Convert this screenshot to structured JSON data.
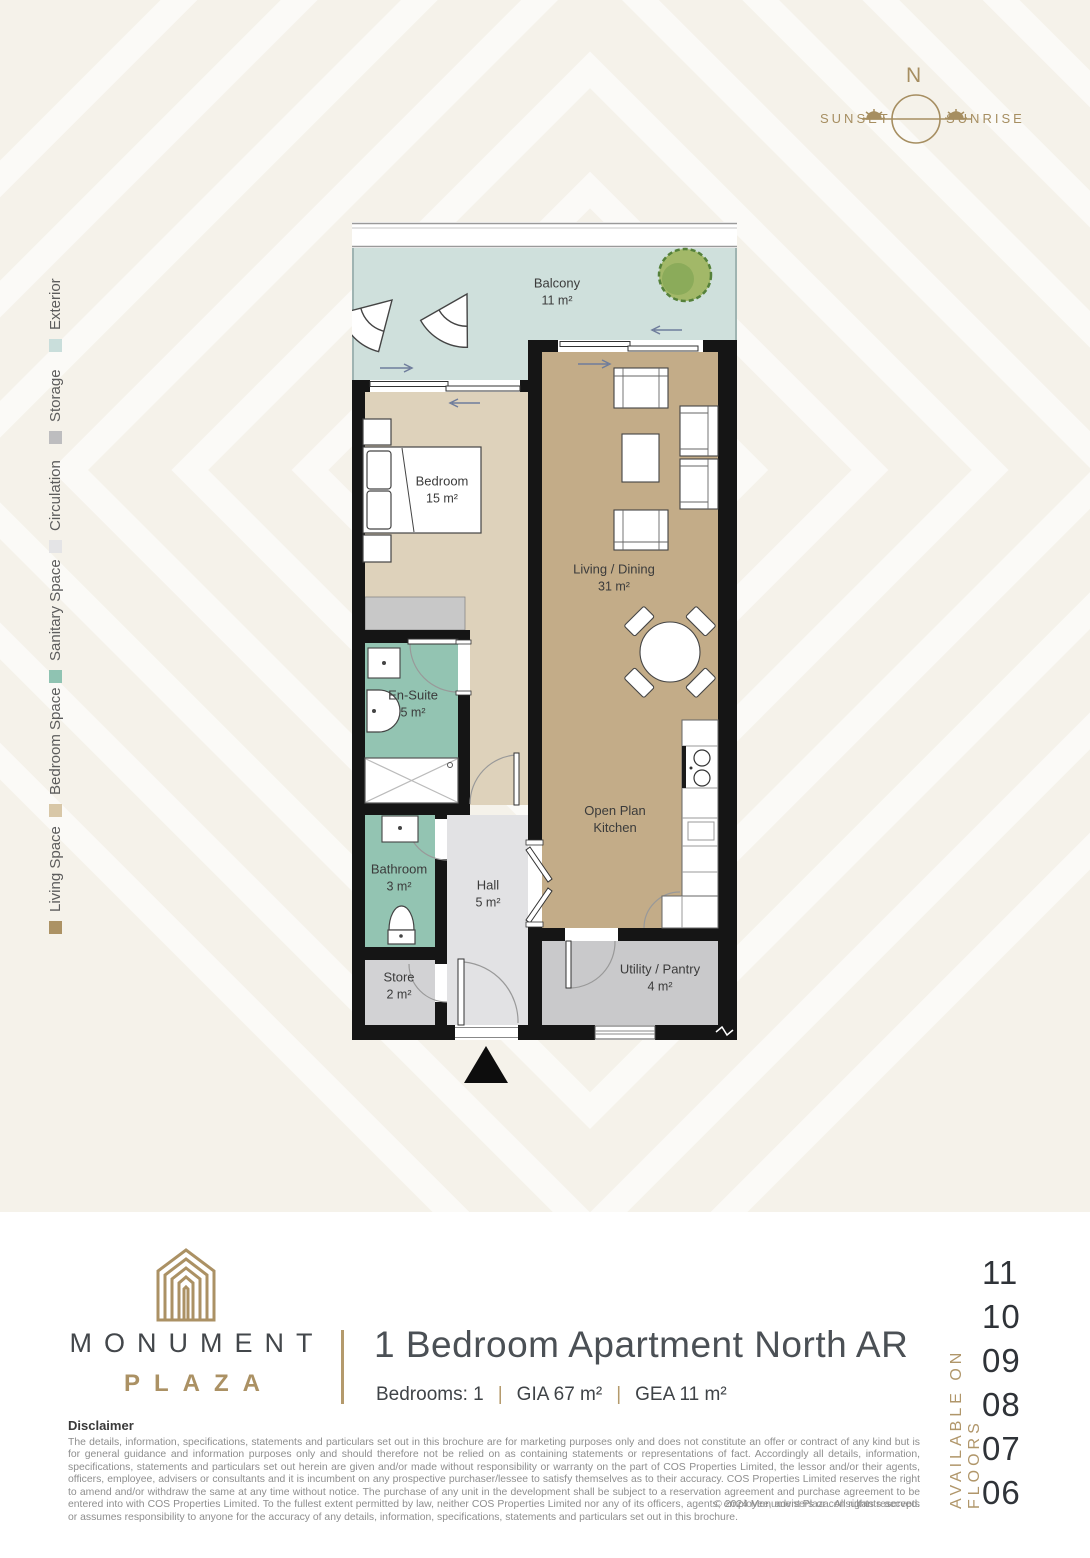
{
  "compass": {
    "north": "N",
    "sunset": "SUNSET",
    "sunrise": "SUNRISE",
    "gold": "#a68e61"
  },
  "legend": {
    "items": [
      {
        "label": "Exterior",
        "color": "#c9dedb"
      },
      {
        "label": "Storage",
        "color": "#bdbdbf"
      },
      {
        "label": "Circulation",
        "color": "#e4e4e6"
      },
      {
        "label": "Sanitary Space",
        "color": "#8fc3b2"
      },
      {
        "label": "Bedroom Space",
        "color": "#d8c7a7"
      },
      {
        "label": "Living Space",
        "color": "#ac9264"
      }
    ]
  },
  "floorplan": {
    "rooms": {
      "balcony": {
        "name": "Balcony",
        "area": "11 m²"
      },
      "bedroom": {
        "name": "Bedroom",
        "area": "15 m²"
      },
      "living": {
        "name": "Living / Dining",
        "area": "31 m²"
      },
      "ensuite": {
        "name": "En-Suite",
        "area": "5 m²"
      },
      "bathroom": {
        "name": "Bathroom",
        "area": "3 m²"
      },
      "hall": {
        "name": "Hall",
        "area": "5 m²"
      },
      "store": {
        "name": "Store",
        "area": "2 m²"
      },
      "kitchen": {
        "name": "Open Plan Kitchen"
      },
      "utility": {
        "name": "Utility / Pantry",
        "area": "4 m²"
      }
    },
    "colors": {
      "exterior": "#cfe0dc",
      "living": "#c3ac88",
      "bedroom": "#ded2bb",
      "sanitary": "#93c4b2",
      "circulation": "#e2e2e4",
      "storage": "#d2d2d4",
      "wall": "#151515"
    }
  },
  "brand": {
    "name": "MONUMENT",
    "sub": "PLAZA",
    "gold": "#ab9164"
  },
  "unit": {
    "title": "1 Bedroom Apartment North AR",
    "specs": [
      {
        "text": "Bedrooms: 1"
      },
      {
        "text": "GIA 67 m²"
      },
      {
        "text": "GEA 11 m²"
      }
    ]
  },
  "availability": {
    "label": "AVAILABLE ON FLOORS",
    "floors": [
      "11",
      "10",
      "09",
      "08",
      "07",
      "06"
    ]
  },
  "disclaimer": {
    "title": "Disclaimer",
    "text": "The details, information, specifications, statements and particulars set out in this brochure are for marketing purposes only and does not constitute an offer or contract of any kind but is for general guidance and information purposes only and should therefore not be relied on as containing statements or representations of fact. Accordingly all details, information, specifications, statements and particulars set out herein are given and/or made without responsibility or warranty on the part of COS Properties Limited, the lessor and/or their agents, officers, employee, advisers or consultants and it is incumbent on any prospective purchaser/lessee to satisfy themselves as to their accuracy. COS Properties Limited reserves the right to amend and/or withdraw the same at any time without notice. The purchase of any unit in the development shall be subject to a reservation agreement and purchase agreement to be entered into with COS Properties Limited. To the fullest extent permitted by law, neither COS Properties Limited nor any of its officers, agents, employee, advisers or consultants accepts or assumes responsibility to anyone for the accuracy of any details, information, specifications, statements and particulars set out in this brochure.",
    "copyright": "© 2024   Monument Plaza. All rights reserved."
  }
}
